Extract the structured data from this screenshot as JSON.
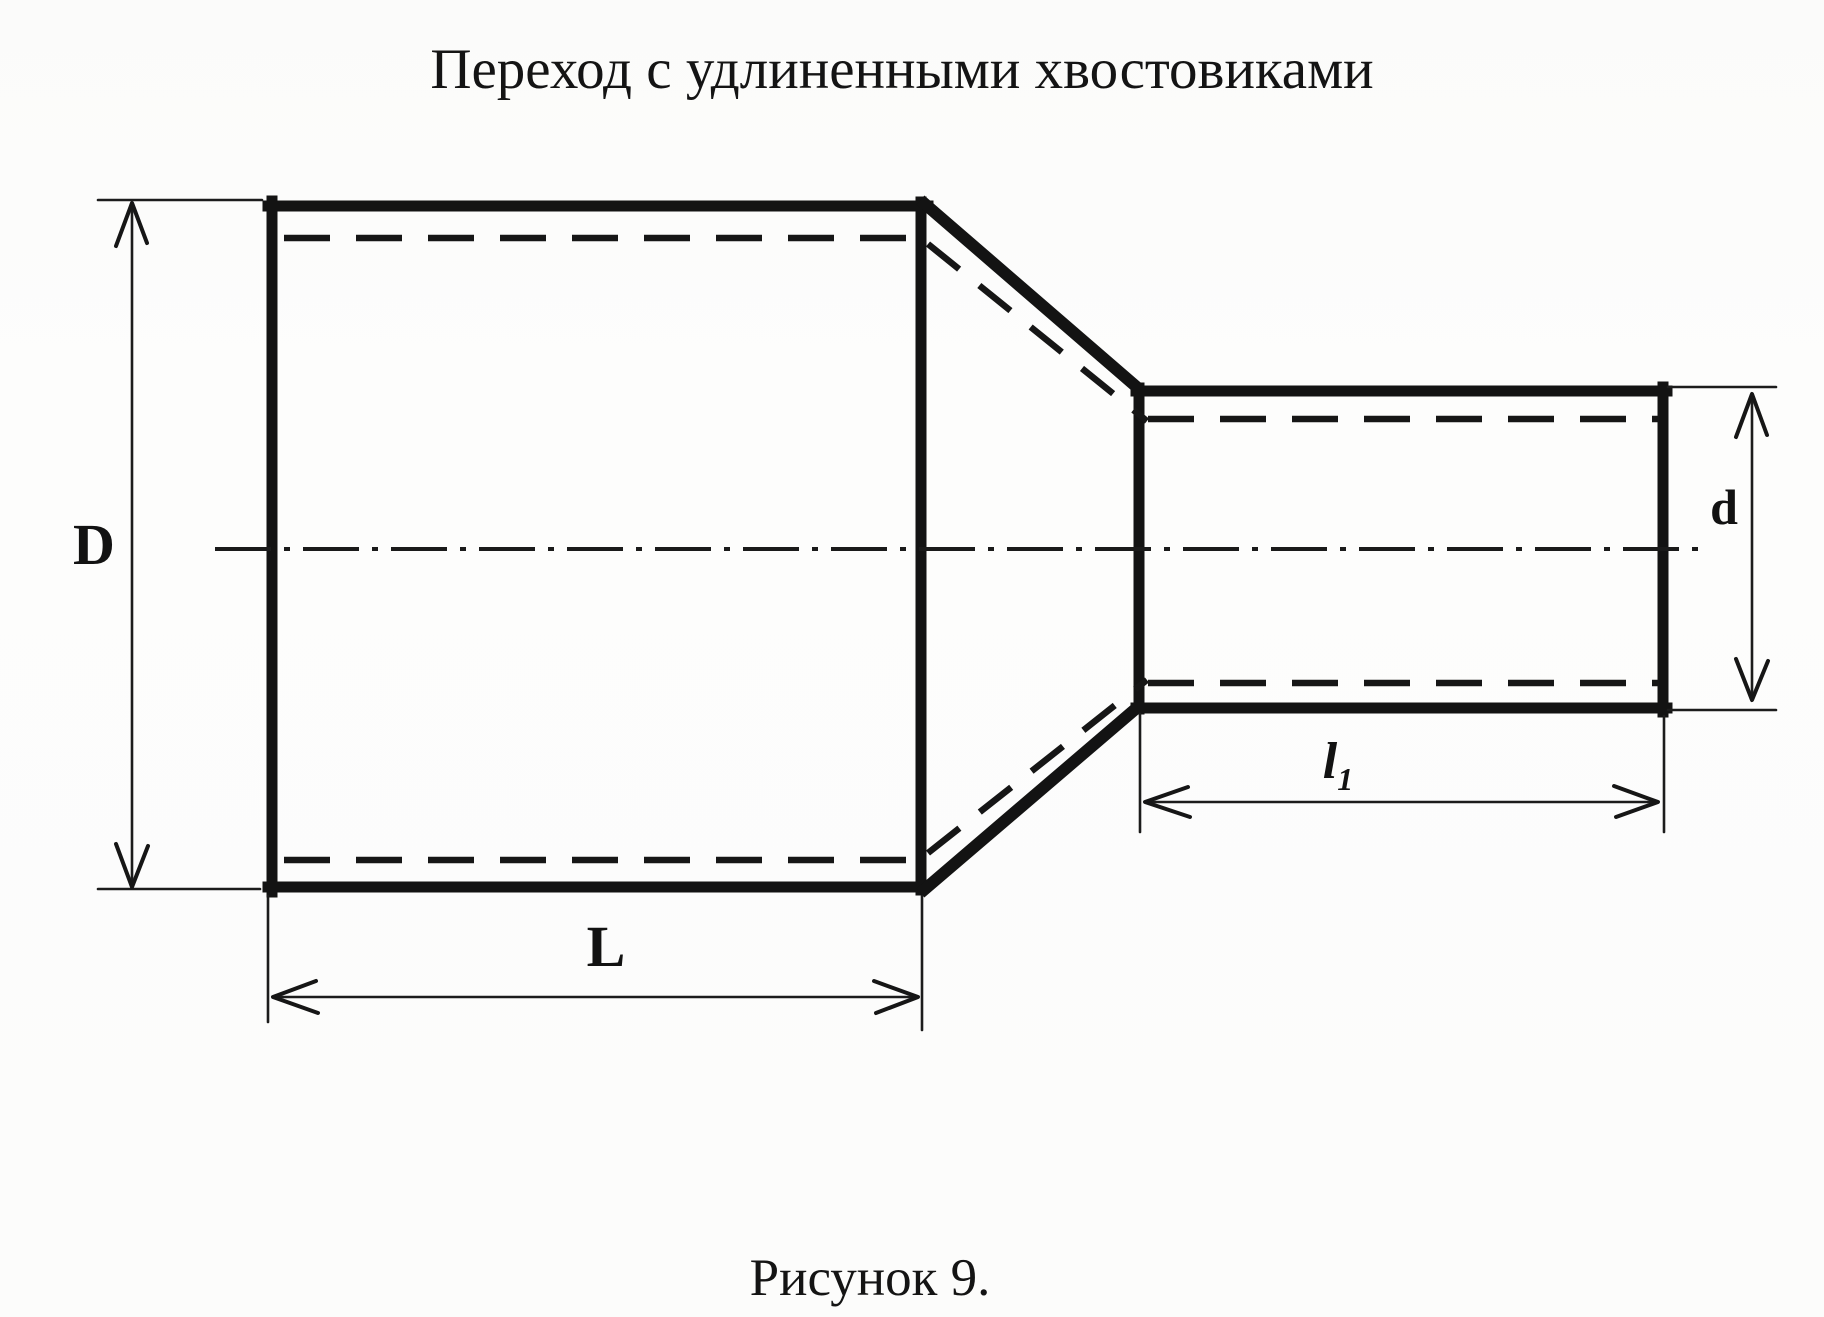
{
  "title": "Переход с удлиненными хвостовиками",
  "caption": "Рисунок 9.",
  "dimension_labels": {
    "large_diameter": "D",
    "small_diameter": "d",
    "large_length": "L",
    "small_length_base": "l",
    "small_length_sub": "1"
  }
}
